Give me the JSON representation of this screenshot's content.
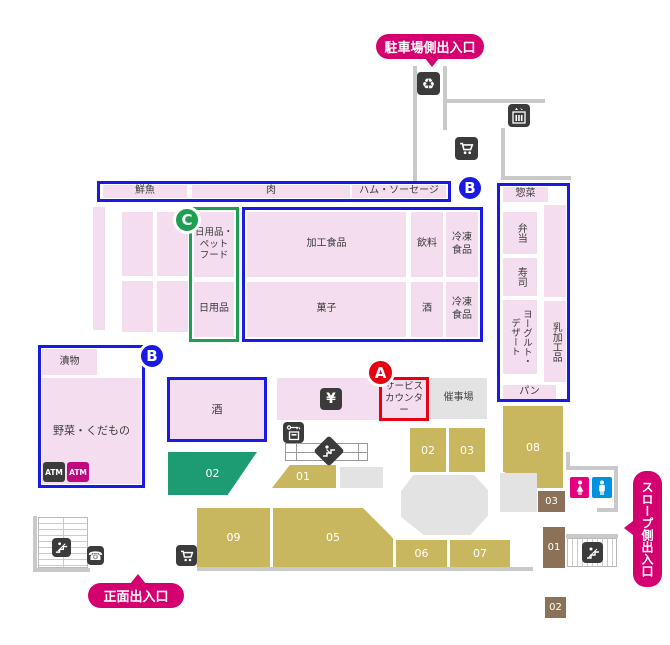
{
  "colors": {
    "pink": "#f3ddee",
    "blue": "#1a1ae6",
    "green": "#1e9e50",
    "teal": "#1d9c74",
    "khaki": "#c9b75f",
    "brown": "#8b7157",
    "magenta": "#d4006f",
    "red": "#e60012",
    "grayline": "#c9c9c9",
    "graybox": "#e3e3e3",
    "dark": "#3b3b3b",
    "female": "#e4007f",
    "male": "#0092e0",
    "atm2bg": "#c0087f",
    "text": "#3a3a3a"
  },
  "bubbles": {
    "parking": "駐車場側出入口",
    "main": "正面出入口",
    "slope": "スロープ側出入口"
  },
  "markers": {
    "a": "A",
    "b_top": "B",
    "b_left": "B",
    "c": "C"
  },
  "top_band": {
    "fresh_fish": "鮮魚",
    "meat": "肉",
    "ham_sausage": "ハム・ソーセージ"
  },
  "center": {
    "daily_pet": "日用品・\nペット\nフード",
    "daily": "日用品",
    "processed": "加工食品",
    "drink": "飲料",
    "frozen_top": "冷凍\n食品",
    "sweets": "菓子",
    "sake_small": "酒",
    "frozen_bottom": "冷凍\n食品"
  },
  "right_col": {
    "deli": "惣菜",
    "bento": "弁当",
    "sushi": "寿司",
    "yogurt_dessert": "ヨーグルト・\nデザート",
    "dairy": "乳加工品",
    "bread": "パン"
  },
  "left_block": {
    "pickles": "漬物",
    "produce": "野菜・くだもの",
    "atm1": "ATM",
    "atm2": "ATM"
  },
  "service": {
    "sake": "酒",
    "yen": "¥",
    "counter": "サービス\nカウンター",
    "event": "催事場"
  },
  "registers": {
    "green_02": "02",
    "k01": "01",
    "k02": "02",
    "k03": "03",
    "k05": "05",
    "k06": "06",
    "k07": "07",
    "k08": "08",
    "k09": "09"
  },
  "rooms": {
    "b03": "03",
    "b01": "01",
    "b02": "02"
  },
  "icons": {
    "recycle": "♻",
    "phone": "☎"
  }
}
